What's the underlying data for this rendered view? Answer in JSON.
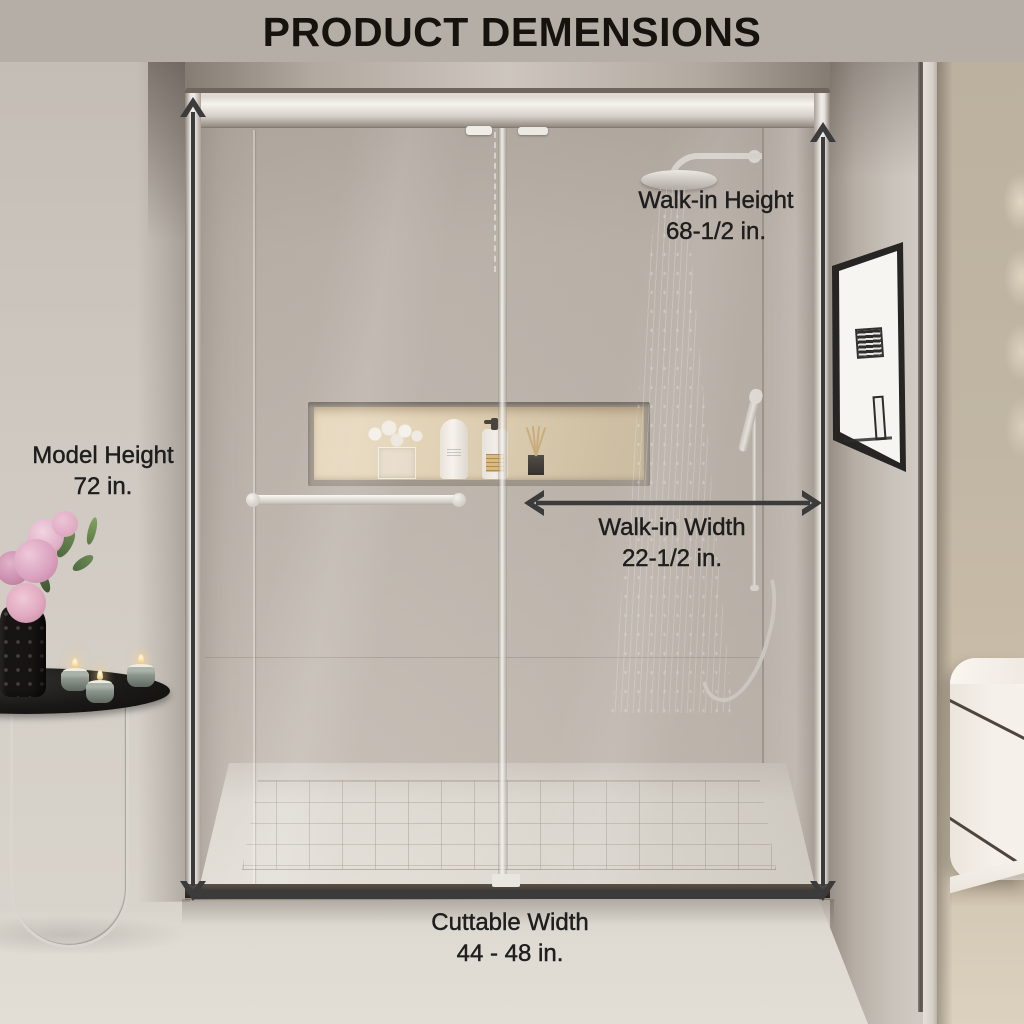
{
  "title": "PRODUCT DEMENSIONS",
  "colors": {
    "title_bg": "#b5aea6",
    "title_text": "#16130f",
    "label_text": "#1e1e1e",
    "arrow": "#3b3b3b"
  },
  "dimensions": {
    "walk_in_height": {
      "label": "Walk-in Height",
      "value": "68-1/2 in."
    },
    "model_height": {
      "label": "Model Height",
      "value": "72 in."
    },
    "walk_in_width": {
      "label": "Walk-in Width",
      "value": "22-1/2 in."
    },
    "cuttable_width": {
      "label": "Cuttable Width",
      "value": "44 - 48 in."
    }
  },
  "scene": {
    "objects": [
      "sliding-glass-shower-door",
      "towel-bar-handle",
      "rain-shower-head",
      "hand-shower",
      "wall-niche-with-toiletries",
      "shower-tray",
      "framed-artwork",
      "vanity-cabinet",
      "floating-shelf",
      "side-table",
      "pink-flower-vase",
      "tealight-candles"
    ]
  }
}
